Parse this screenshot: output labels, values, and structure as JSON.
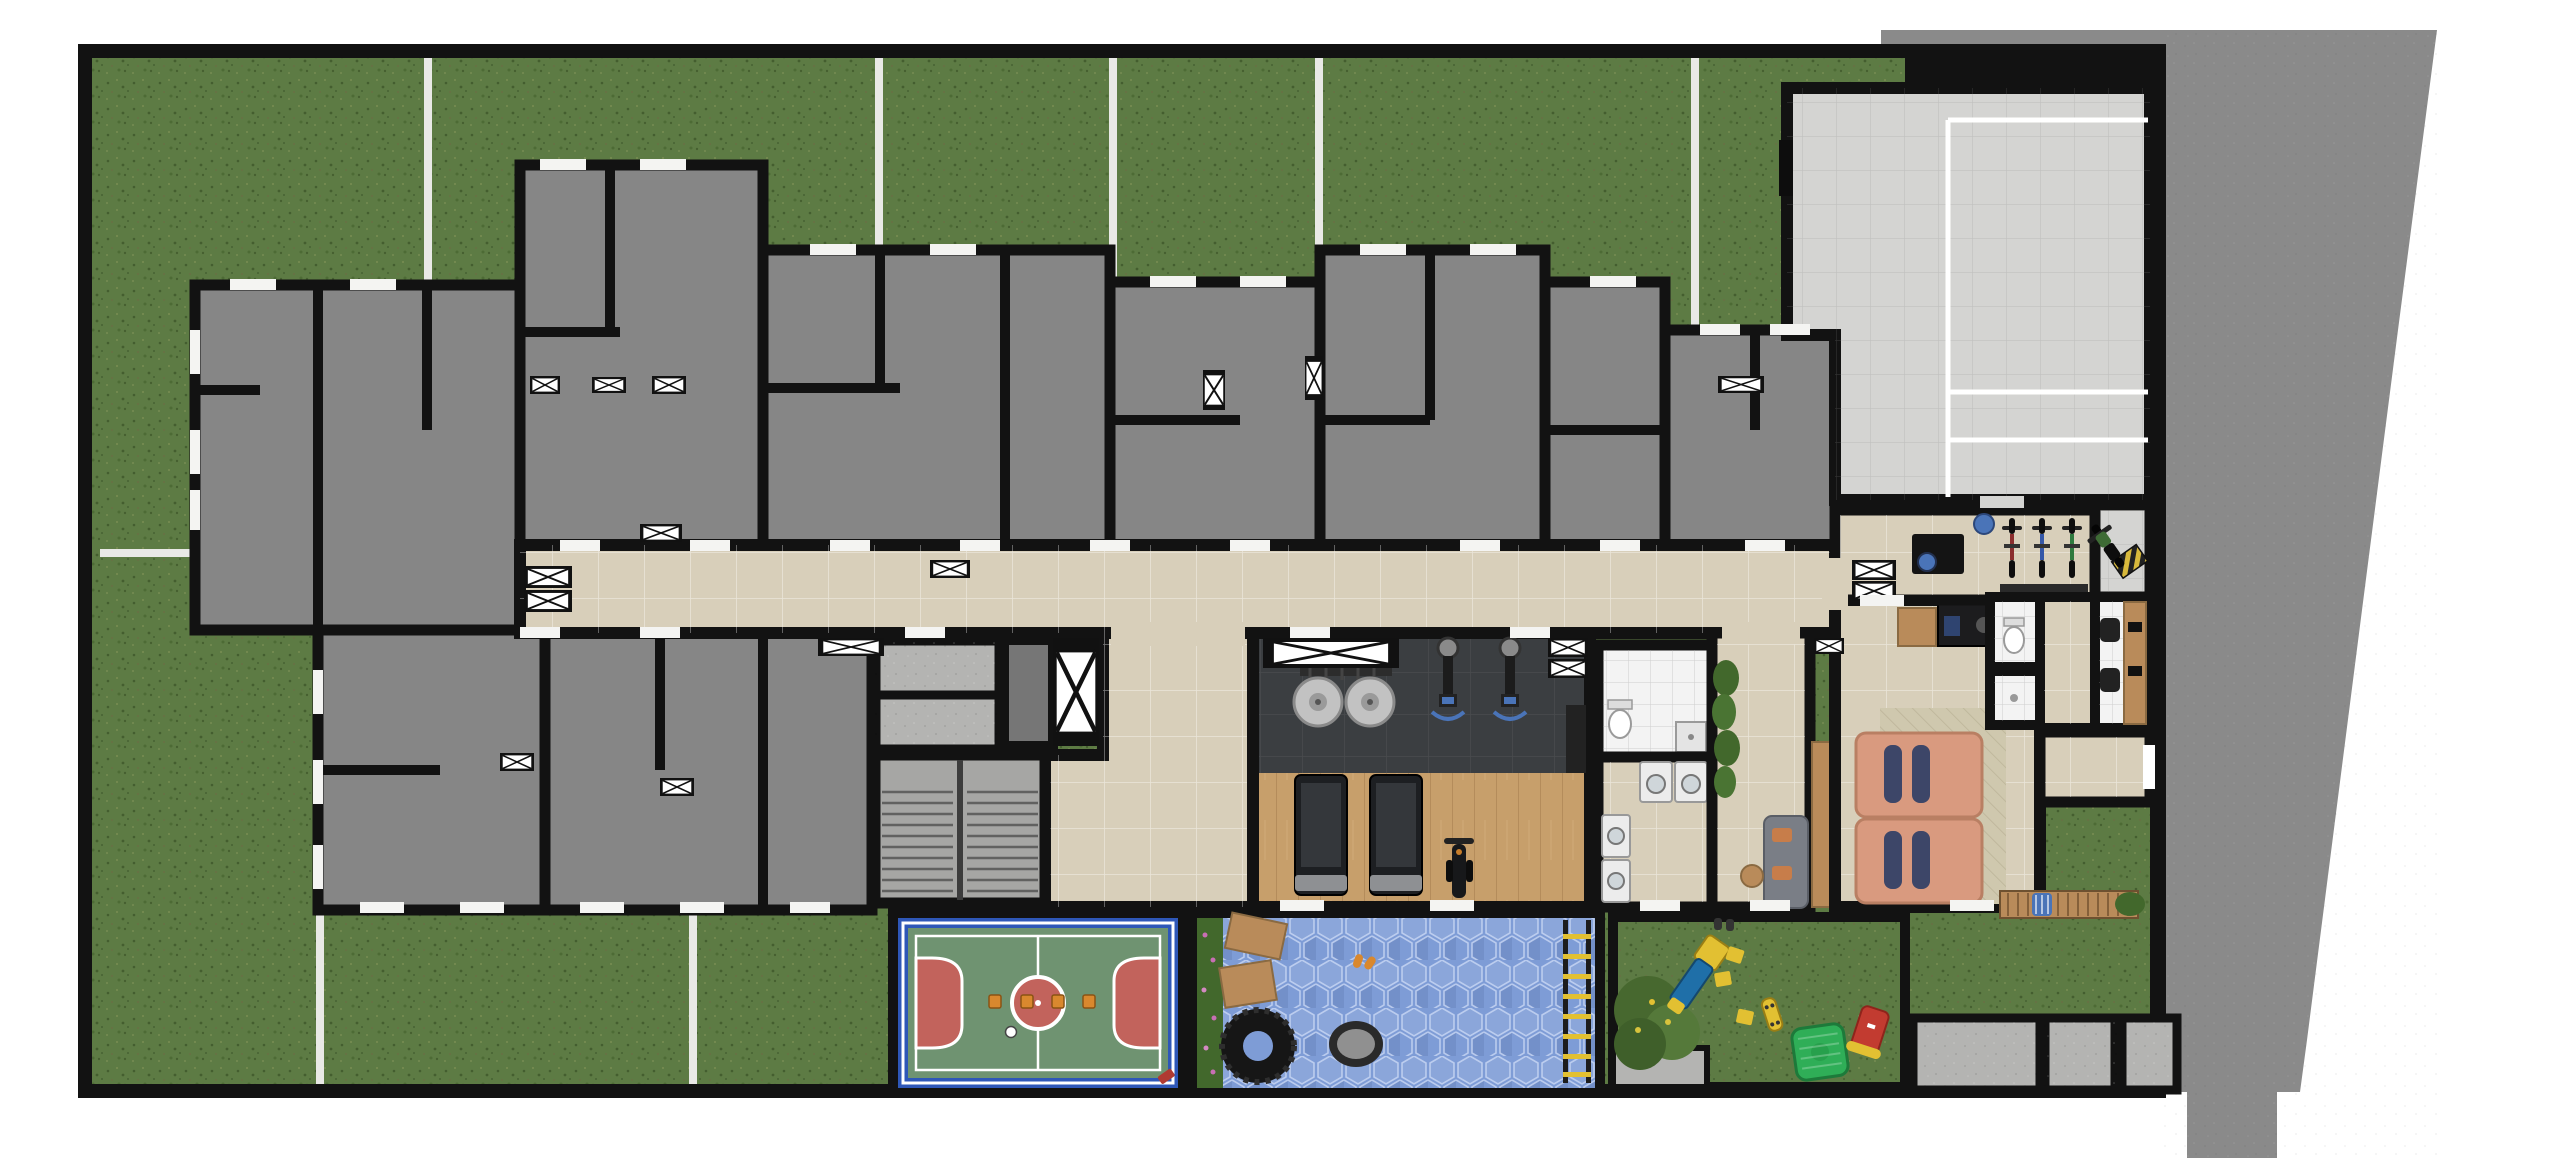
{
  "meta": {
    "type": "architectural-floor-plan",
    "description": "Top-down ground-floor implantation plan of a residential building: private grass gardens, unfurnished apartment units, central corridor with elevator core and stairs, gym, laundry, party room, entrance plaza, futsal court, rubber-floor play area and playground.",
    "width_px": 2560,
    "height_px": 1161
  },
  "palette": {
    "outside": "#ffffff",
    "sidewalk": "#8a8a8a",
    "wall": "#121212",
    "grass": "#5d7b44",
    "unit_floor": "#868686",
    "corridor_tile": "#d8cfba",
    "concrete": "#b4b4b2",
    "stair": "#a6a6a4",
    "gym_floor_dark": "#3b3e41",
    "gym_floor_wood": "#c79f6b",
    "court_border": "#2e57b8",
    "court_field": "#6f9371",
    "court_goal": "#c2635c",
    "court_line": "#ffffff",
    "play_floor_hex": "#7e9cd6",
    "hedge": "#42682c",
    "flower": "#c86fb4",
    "plaza_tile": "#d4d4d2",
    "white_room": "#f3f3f3",
    "rug": "#cfc8ae",
    "sofa_salmon": "#d99a7f",
    "cushion_navy": "#3d4668",
    "wood": "#b98b5a",
    "black_furniture": "#1c1c1e",
    "appliance": "#ececec",
    "accent_blue": "#4a74b8",
    "slide_blue": "#1f6fa8",
    "play_yellow": "#e2c032",
    "play_green": "#2fae57",
    "play_red": "#c23b30",
    "cone_orange": "#d9882e",
    "tire_black": "#161616",
    "trampoline_gray": "#909090",
    "divider_white": "#e9e9e6"
  },
  "areas": [
    {
      "id": "private-gardens",
      "label": "Private gardens (grass plots with white dividers)"
    },
    {
      "id": "apartment-units",
      "label": "Ground-floor apartment units (unfurnished, gray)"
    },
    {
      "id": "corridor",
      "label": "Central circulation corridor (beige tile)"
    },
    {
      "id": "elevators",
      "label": "Elevator / duct shafts (X boxes)"
    },
    {
      "id": "stairwell",
      "label": "Stairwell"
    },
    {
      "id": "technical-rooms",
      "label": "Technical / service rooms"
    },
    {
      "id": "gym",
      "label": "Gym: dark tile + wood floor"
    },
    {
      "id": "gym-bathroom",
      "label": "Gym bathroom"
    },
    {
      "id": "laundry",
      "label": "Shared laundry"
    },
    {
      "id": "lounge",
      "label": "Small lounge with gray sofa"
    },
    {
      "id": "party-room",
      "label": "Party room with salmon sofa, rug and kitchenette"
    },
    {
      "id": "entrance-hall",
      "label": "Entrance hall with reception desk"
    },
    {
      "id": "bike-rack",
      "label": "Bicycle rack (3 bikes)"
    },
    {
      "id": "bike-bay",
      "label": "Bike/moto bay with hazard-striped pad"
    },
    {
      "id": "office",
      "label": "Administration office with desk and 2 chairs"
    },
    {
      "id": "restrooms",
      "label": "Restrooms near office"
    },
    {
      "id": "entrance-plaza",
      "label": "Paved entrance courtyard with white floor markings"
    },
    {
      "id": "futsal-court",
      "label": "Futsal court (blue frame, green field, red goal areas)"
    },
    {
      "id": "play-rubber",
      "label": "Blue hex rubber-floor play/crossfit area (tire, trampoline, platforms, ladder)"
    },
    {
      "id": "playground",
      "label": "Playground lawn (slide, playhouse, rocker, tree)"
    },
    {
      "id": "bench-garden",
      "label": "Garden with long wooden bench"
    },
    {
      "id": "service-boxes",
      "label": "Utility rooms at bottom-right"
    },
    {
      "id": "sidewalk",
      "label": "Public sidewalk wrapping top-right, diagonal edge"
    }
  ],
  "amenities": {
    "futsal_court": {
      "cones": 4,
      "balls": 1,
      "center_circle": "red with white ring",
      "goal_areas": 2
    },
    "gym": {
      "treadmills": 2,
      "weight_plate_racks": 2,
      "cable_stations": 2,
      "exercise_bikes": 1,
      "cabinets": 1
    },
    "laundry": {
      "washing_machines": 4
    },
    "bike_rack": {
      "bicycles": 3,
      "bike_colors": [
        "#8b2e2e",
        "#3558a8",
        "#2e7a3e"
      ]
    },
    "play_rubber_area": {
      "tires": 1,
      "trampolines": 1,
      "wood_platforms": 2,
      "ladders": 1,
      "sandals_pairs": 1,
      "flower_hedge": true
    },
    "playground": {
      "slides": 1,
      "playhouses": 1,
      "rockers": 1,
      "stepping_pads": 3,
      "skateboards": 1,
      "trees": 1
    },
    "party_room": {
      "sofa_modules": 2,
      "navy_cushions": 4,
      "rugs": 1,
      "kitchen_counters": 2
    },
    "lounge": {
      "sofas": 1,
      "orange_cushions": 2,
      "side_tables": 1
    },
    "office": {
      "desks": 1,
      "chairs": 2,
      "monitors": 2
    },
    "reception": {
      "desks": 1,
      "blue_chairs": 1,
      "blue_ball": 1
    },
    "bench_garden": {
      "benches": 1,
      "blue_pillows": 1,
      "bushes": 1
    },
    "core": {
      "elevator_shafts": 2,
      "big_shaft": 1,
      "stair_flights": 2
    },
    "shaft_boxes_total": 18
  }
}
